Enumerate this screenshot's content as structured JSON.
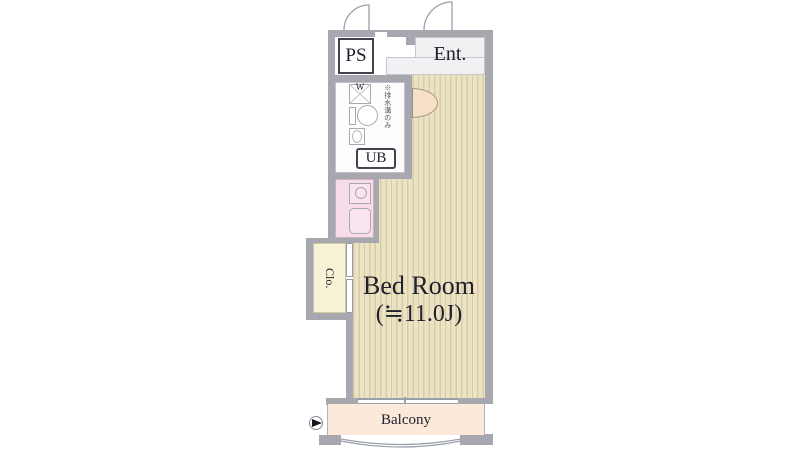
{
  "plan": {
    "rooms": {
      "ps": "PS",
      "entrance": "Ent.",
      "unit_bath": "UB",
      "closet": "Clo.",
      "bedroom_name": "Bed Room",
      "bedroom_size": "(≒11.0J)",
      "balcony": "Balcony"
    },
    "fixtures": {
      "washer_mark": "W",
      "washer_note": "※排水溝のみ"
    },
    "colors": {
      "wall": "#a7a7af",
      "flooring": "#ece3c4",
      "flooring_stripe": "#d7cca6",
      "kitchen": "#f8dcea",
      "closet": "#f7f3d4",
      "balcony": "#fce9da",
      "door": "#f6e0c8",
      "text": "#20202c"
    }
  }
}
